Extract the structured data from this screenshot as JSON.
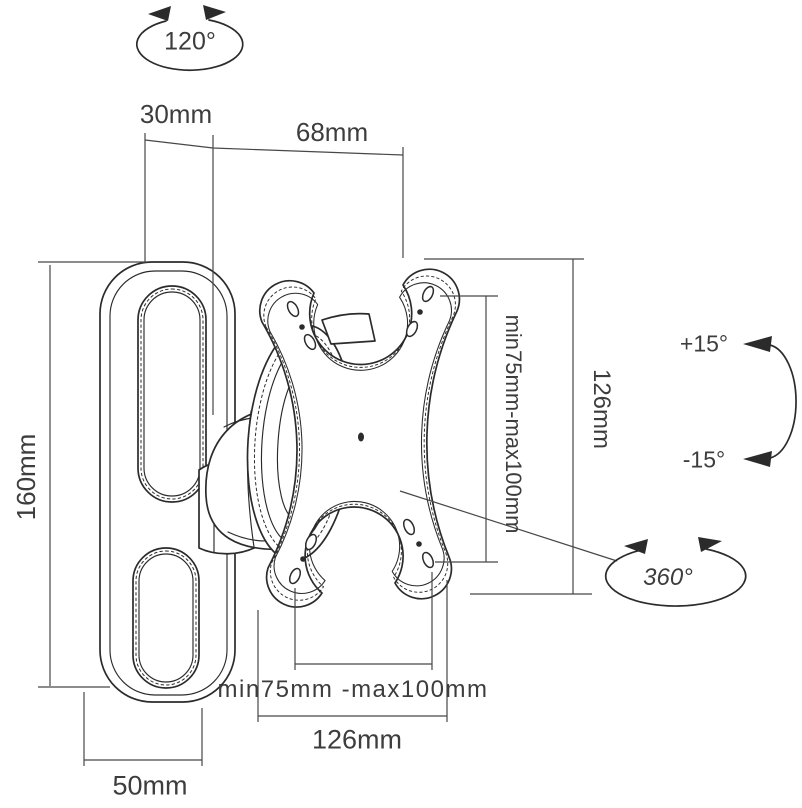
{
  "labels": {
    "swivel_range": "120°",
    "wall_offset": "30mm",
    "arm_extension": "68mm",
    "vesa_vertical": "min75mm-max100mm",
    "plate_height": "126mm",
    "tilt_up": "+15°",
    "tilt_down": "-15°",
    "rotation": "360°",
    "bracket_height": "160mm",
    "vesa_horizontal": "min75mm -max100mm",
    "plate_width": "126mm",
    "bracket_width": "50mm"
  },
  "colors": {
    "background": "#ffffff",
    "line": "#2b2b2b",
    "dimension": "#474747",
    "text": "#3d3d3d"
  }
}
